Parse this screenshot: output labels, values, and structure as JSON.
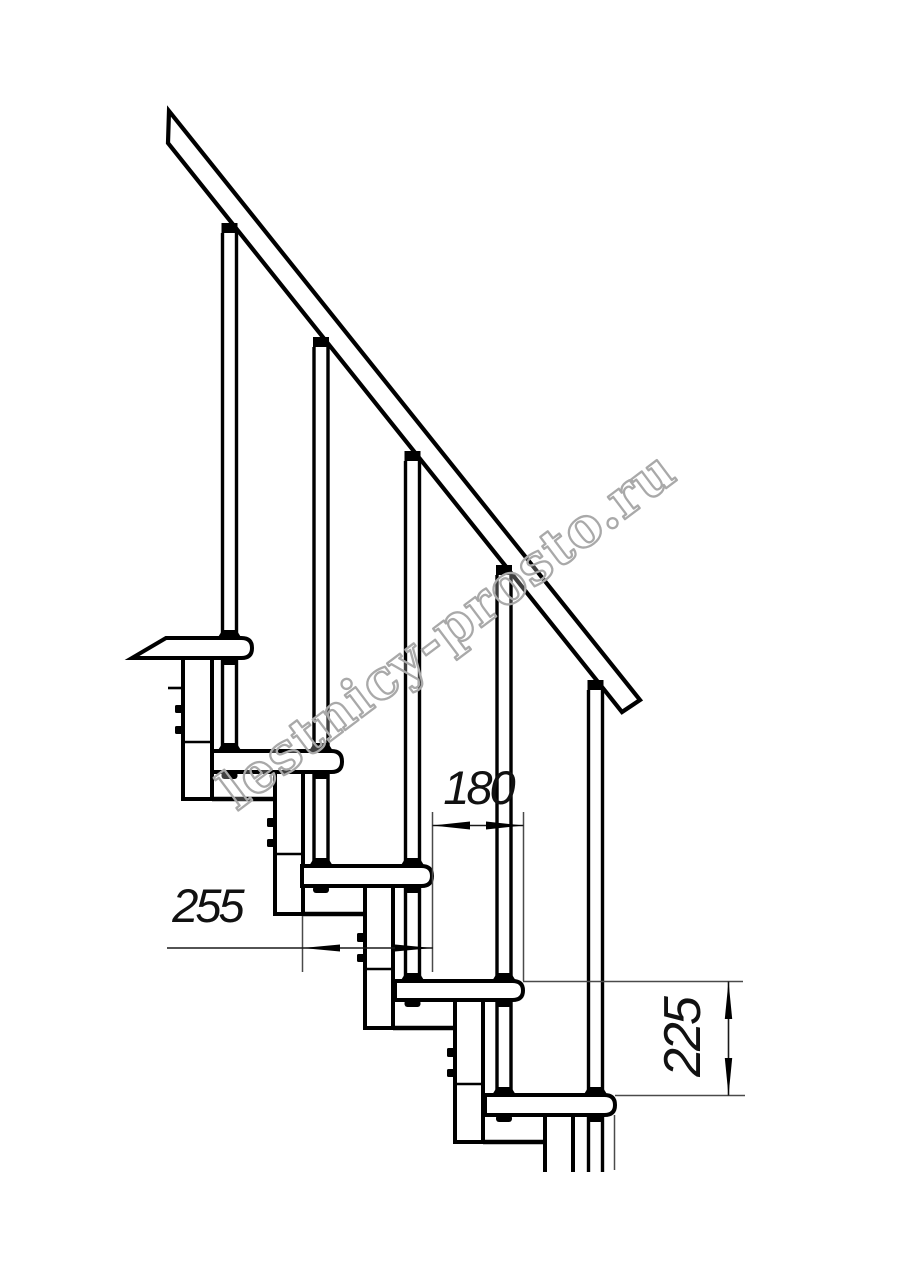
{
  "drawing": {
    "subject": "modular staircase side elevation",
    "treads_visible": 5,
    "balusters_visible": 5,
    "support_columns_visible": 5,
    "handrail": "diagonal handrail descending left to right"
  },
  "dimensions": {
    "tread_depth": "255",
    "step_run": "180",
    "step_rise": "225"
  },
  "watermark": {
    "text": "lestnicy-prosto.ru",
    "stroke_color": "#a9a9a9"
  },
  "colors": {
    "background": "#ffffff",
    "main_line": "#000000",
    "dimension_line": "#1a1a1a",
    "extension_line": "#4a4a4a"
  }
}
